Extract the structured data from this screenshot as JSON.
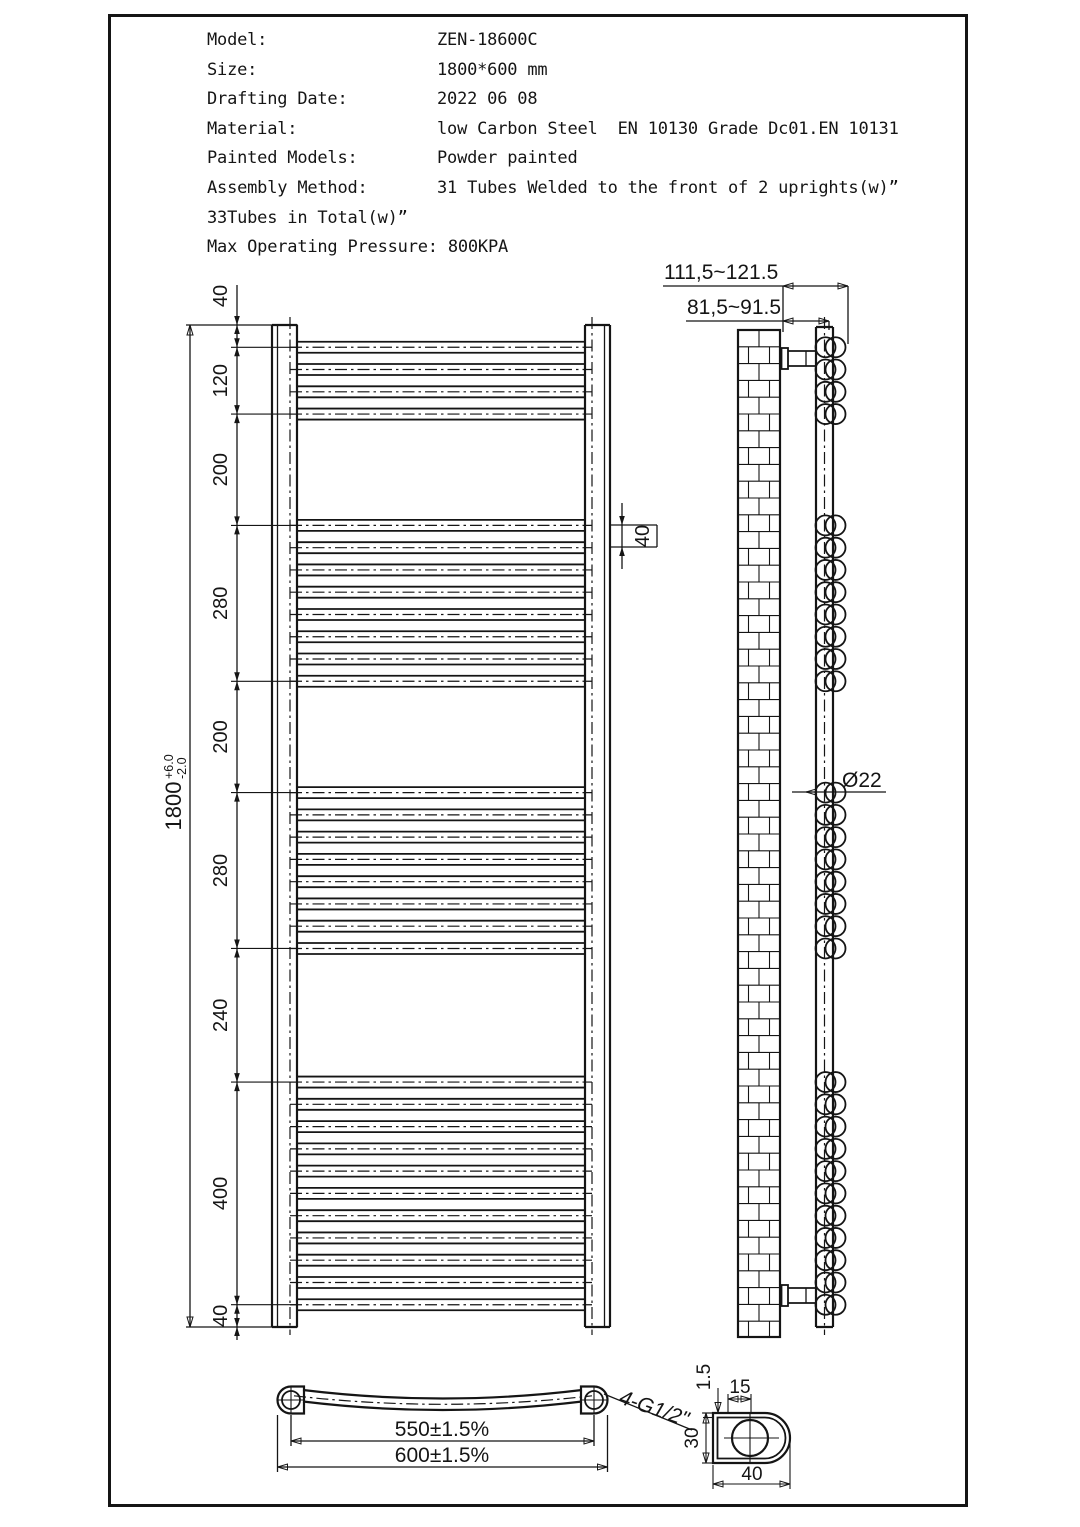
{
  "specs": {
    "rows": [
      {
        "label": "Model:",
        "value": "ZEN-18600C"
      },
      {
        "label": "Size:",
        "value": "1800*600 mm"
      },
      {
        "label": "Drafting Date:",
        "value": "2022 06 08"
      },
      {
        "label": "Material:",
        "value": "low Carbon Steel  EN 10130 Grade Dc01.EN 10131"
      },
      {
        "label": "Painted Models:",
        "value": "Powder painted"
      },
      {
        "label": "Assembly Method:",
        "value": "31 Tubes Welded to the front of 2 uprights(w)”"
      }
    ],
    "line_total_tubes": "33Tubes in Total(w)”",
    "pressure_label": "Max Operating Pressure:",
    "pressure_value": "800KPA"
  },
  "front_view": {
    "overall": {
      "value": "1800",
      "tol_plus": "+6.0",
      "tol_minus": "-2.0"
    },
    "chain_labels": [
      "40",
      "120",
      "200",
      "280",
      "200",
      "280",
      "240",
      "400",
      "40"
    ],
    "pitch_label": "40"
  },
  "side_view": {
    "offset_outer": "111,5~121.5",
    "offset_inner": "81,5~91.5",
    "tube_diameter": "Ø22"
  },
  "bottom_view": {
    "centers_dim": "550±1.5%",
    "overall_dim": "600±1.5%",
    "thread_label": "4-G1/2\""
  },
  "detail_view": {
    "wall_thickness": "1.5",
    "width_top": "15",
    "depth": "30",
    "width_bottom": "40"
  },
  "drawing": {
    "total_height_mm": 1800,
    "tube_count_front": 31,
    "tube_groups": [
      {
        "start_mm": 40,
        "count": 4,
        "pitch_mm": 40
      },
      {
        "start_mm": 360,
        "count": 8,
        "pitch_mm": 40
      },
      {
        "start_mm": 840,
        "count": 8,
        "pitch_mm": 40
      },
      {
        "start_mm": 1360,
        "count": 11,
        "pitch_mm": 40
      }
    ]
  }
}
